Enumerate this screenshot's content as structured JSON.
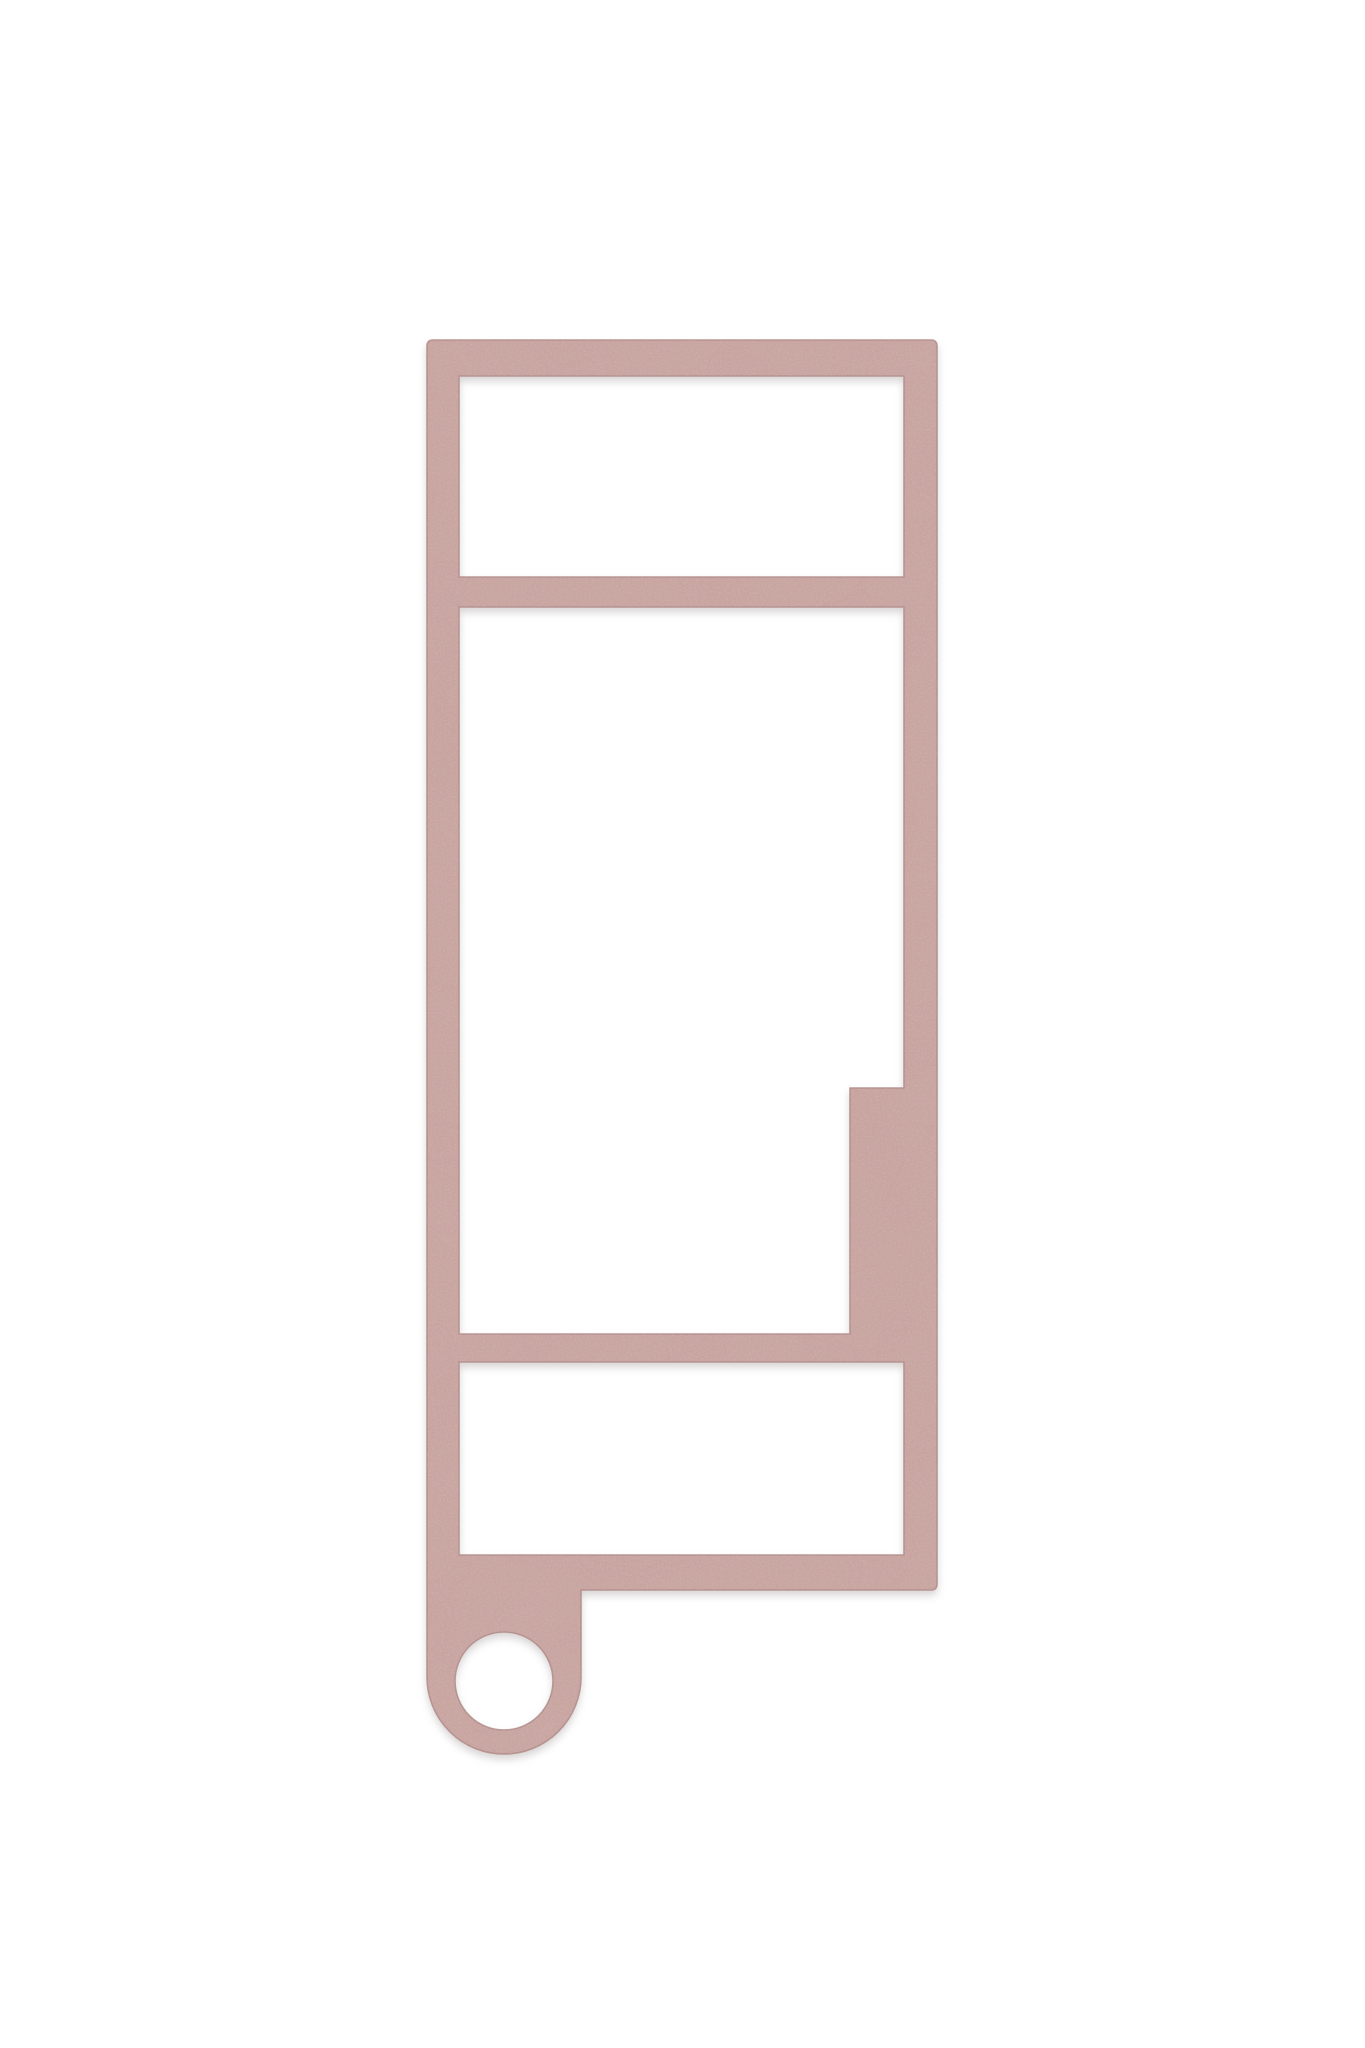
{
  "scene": {
    "description": "3D render of a flat dusty-pink rectangular frame template with a top crossbar window, a large middle window with a right-side step notch, a lower window, and a bottom-left keyring tab with a circular hole",
    "background_color": "#ffffff",
    "object": {
      "name": "frame-template-with-keyring-tab",
      "fill_color": "#c8a4a0",
      "edge_color": "#af8b88",
      "highlight_color": "#e9d4cf",
      "grain_dark_color": "#8d6f6c",
      "drop_shadow_color": "#8a7f7d"
    }
  }
}
